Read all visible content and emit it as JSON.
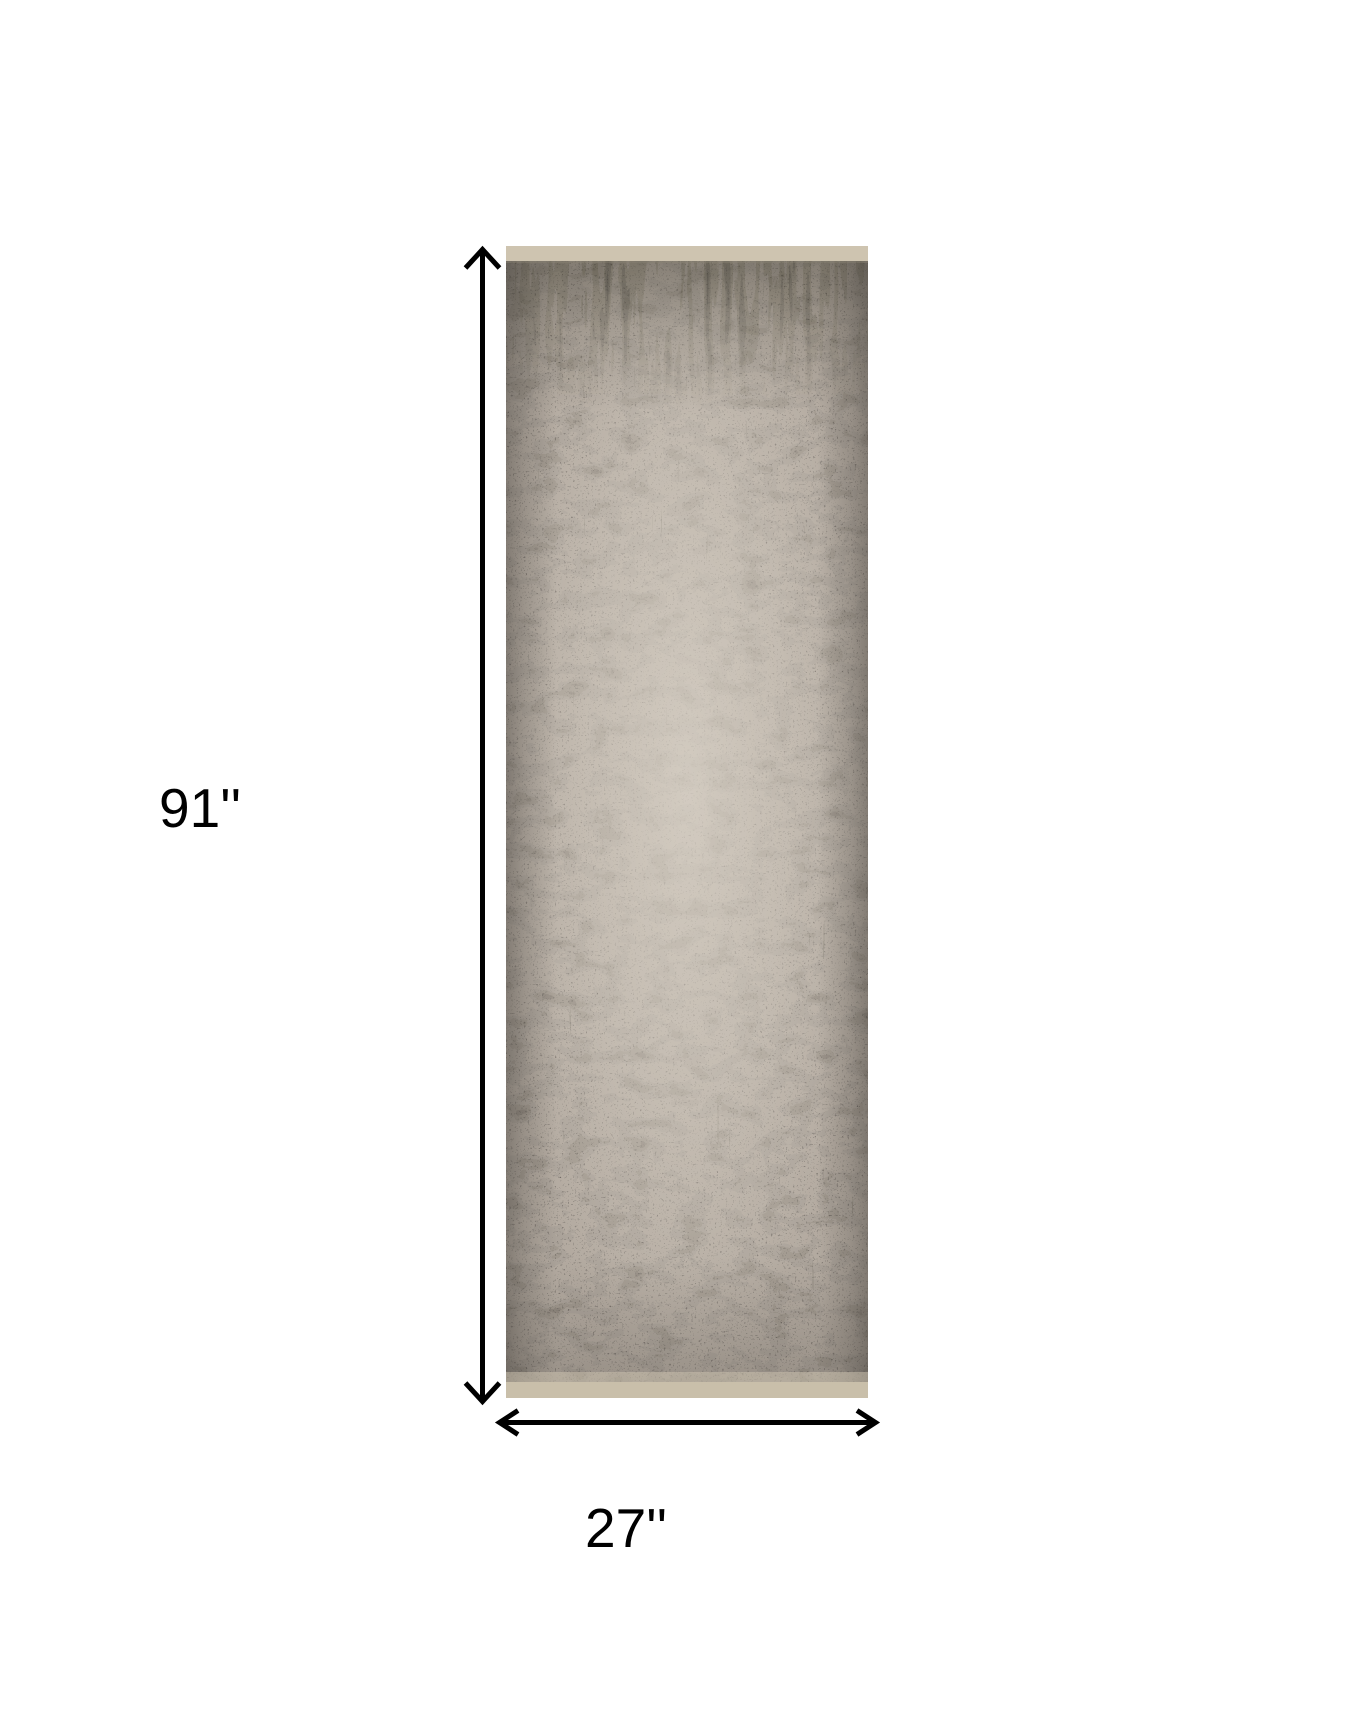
{
  "figure": {
    "type": "product-dimension-image",
    "background_color": "#ffffff"
  },
  "rug": {
    "description": "Distressed abstract gray runner rug shown vertically",
    "colors": {
      "pile_base": "#b3aaa0",
      "dark_speckle": "#26231f",
      "mottle": "#45403a",
      "center_highlight": "#ddd6cb",
      "edge_shading": "#3b3732",
      "top_binding": "#cec4b0",
      "bottom_binding": "#c9bfaa"
    }
  },
  "dimensions": {
    "height": {
      "label": "91''",
      "value": 91,
      "unit": "inches"
    },
    "width": {
      "label": "27''",
      "value": 27,
      "unit": "inches"
    }
  },
  "annotation": {
    "arrow_color": "#000000",
    "label_color": "#000000"
  }
}
